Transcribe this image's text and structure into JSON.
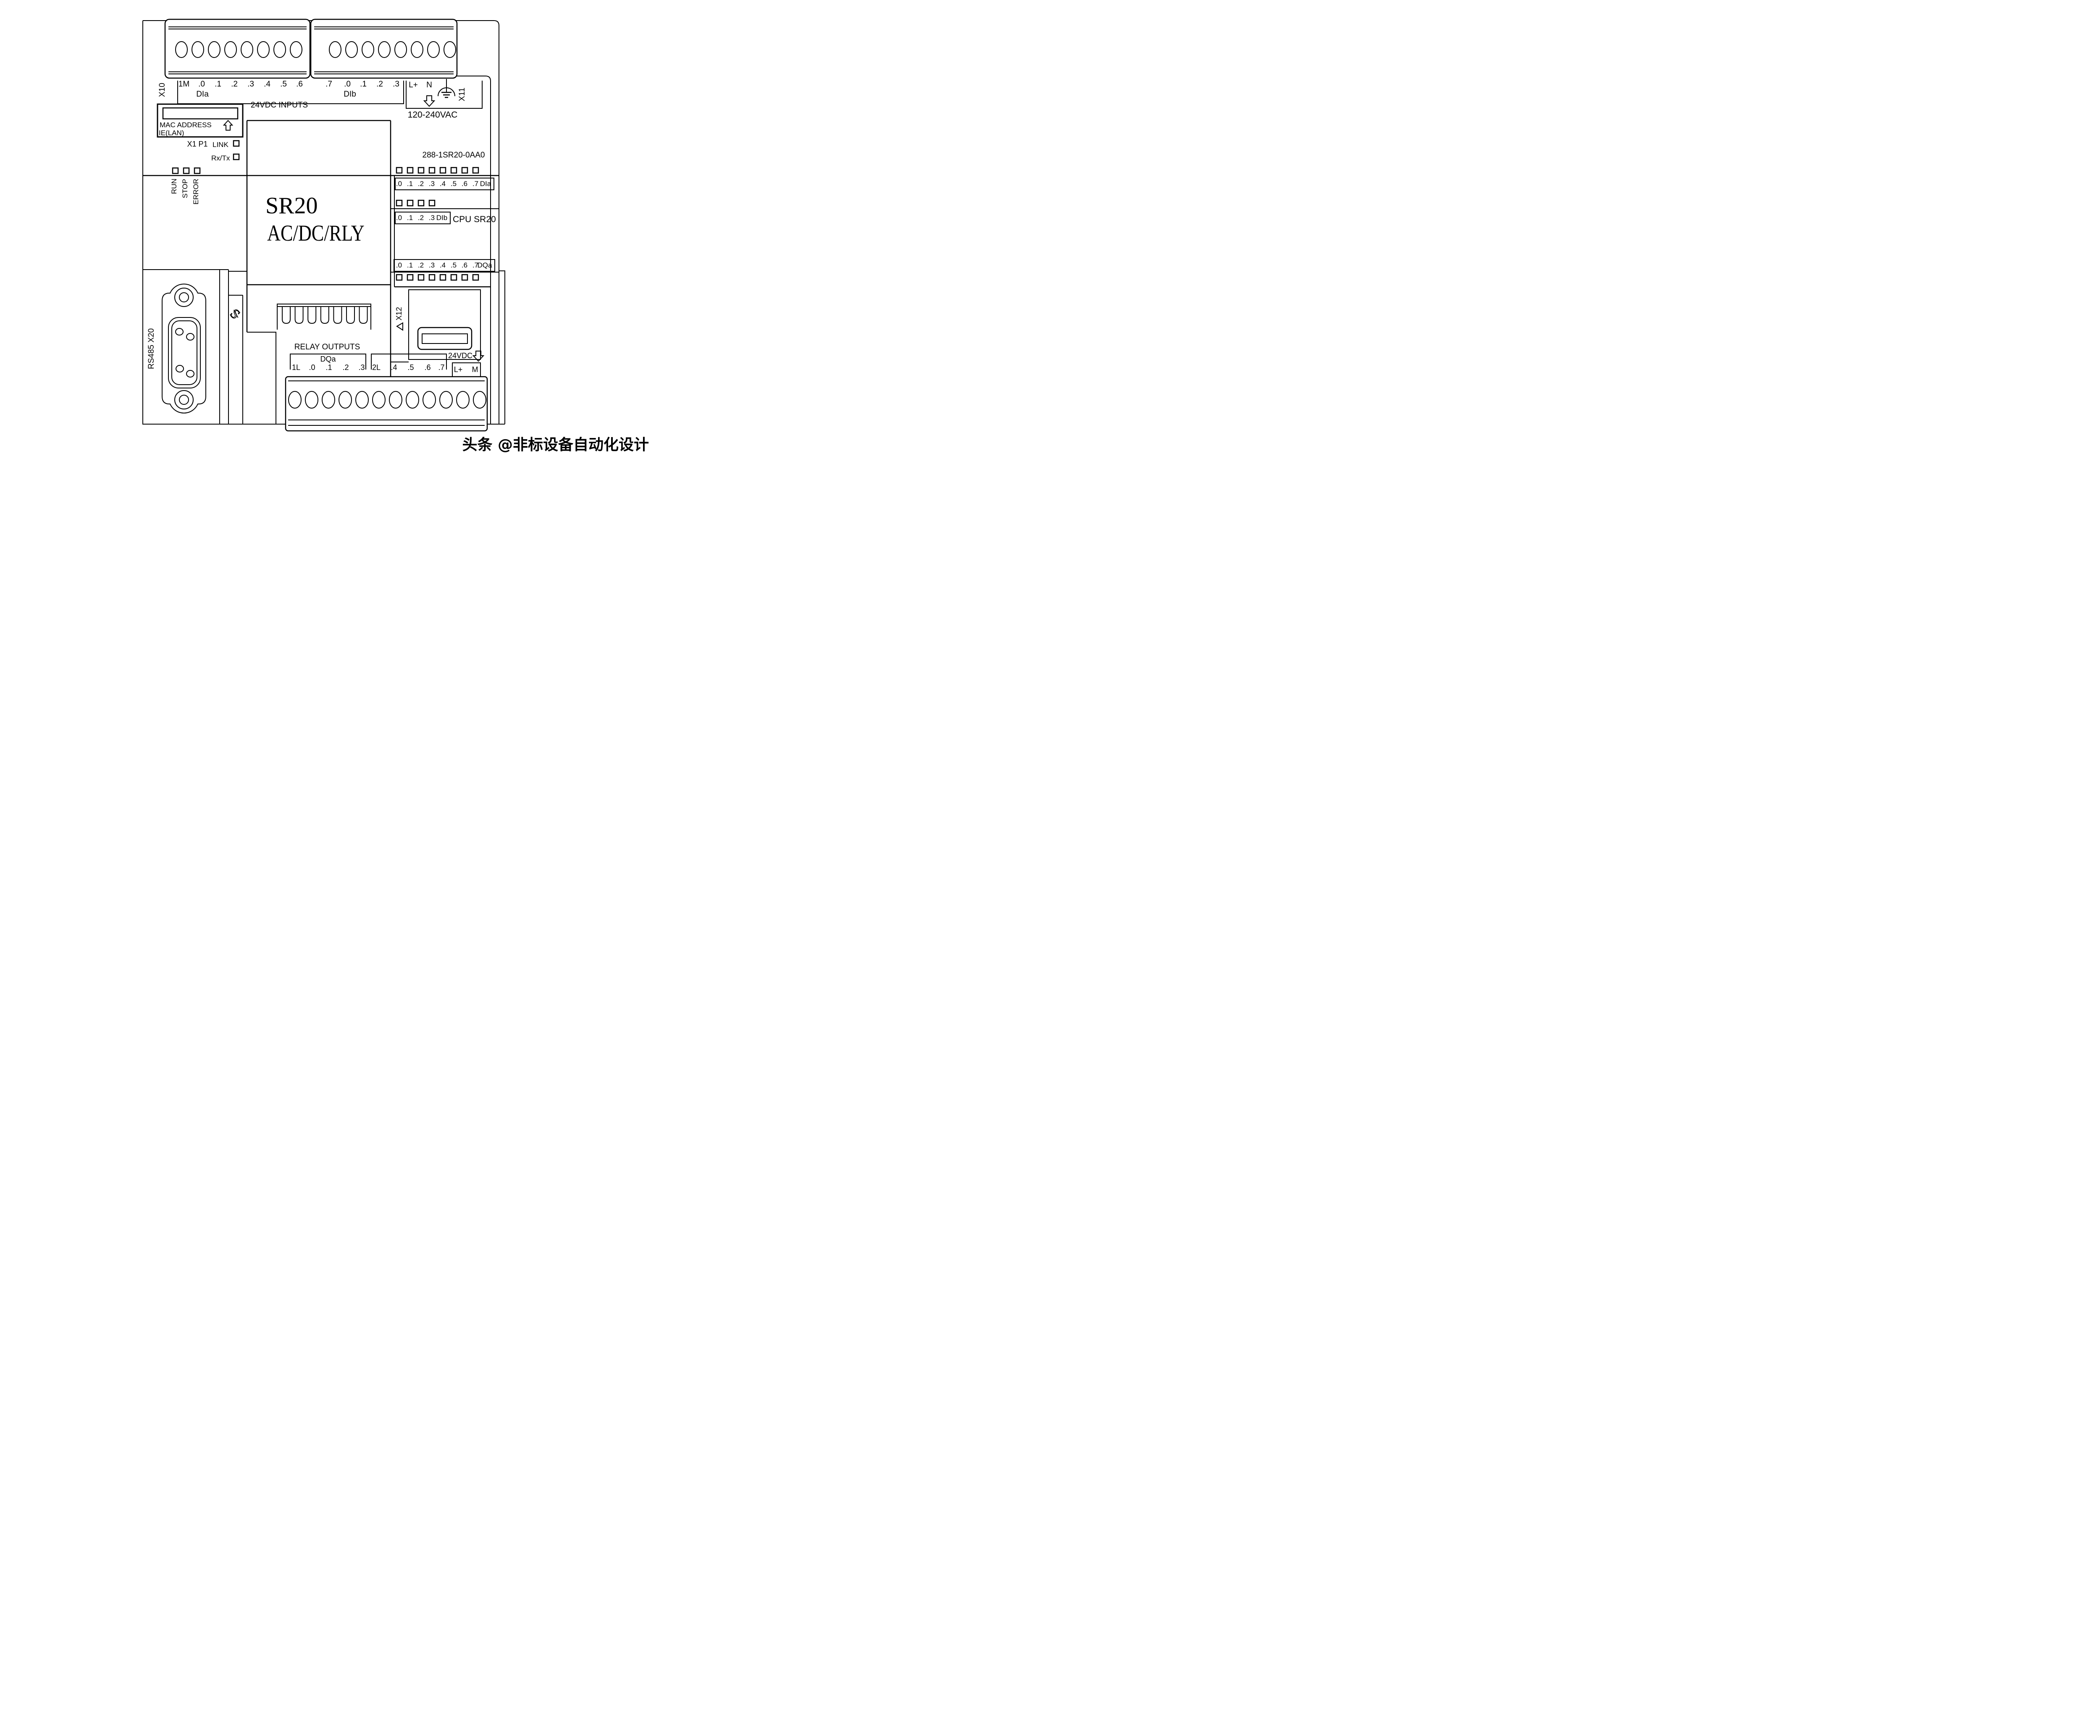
{
  "top": {
    "x10_label": "X10",
    "x11_label": "X11",
    "labels_left": [
      "1M",
      ".0",
      ".1",
      ".2",
      ".3",
      ".4",
      ".5",
      ".6"
    ],
    "labels_right": [
      ".7",
      ".0",
      ".1",
      ".2",
      ".3"
    ],
    "dia_group": "DIa",
    "dib_group": "DIb",
    "inputs_caption": "24VDC INPUTS",
    "power_lplus": "L+",
    "power_n": "N",
    "power_caption": "120-240VAC"
  },
  "ethernet": {
    "mac": "MAC ADDRESS",
    "ie": "IE(LAN)",
    "port": "X1 P1",
    "link": "LINK",
    "rxtx": "Rx/Tx"
  },
  "model": "288-1SR20-0AA0",
  "status": [
    "RUN",
    "STOP",
    "ERROR"
  ],
  "center": {
    "line1": "SR20",
    "line2": "AC/DC/RLY"
  },
  "cpu_label": "CPU SR20",
  "leds": {
    "dia": {
      "labels": [
        ".0",
        ".1",
        ".2",
        ".3",
        ".4",
        ".5",
        ".6",
        ".7"
      ],
      "name": "DIa"
    },
    "dib": {
      "labels": [
        ".0",
        ".1",
        ".2",
        ".3"
      ],
      "name": "DIb"
    },
    "dqa": {
      "labels": [
        ".0",
        ".1",
        ".2",
        ".3",
        ".4",
        ".5",
        ".6",
        ".7"
      ],
      "name": "DQa"
    }
  },
  "expansion": "X12",
  "serial": "RS485 X20",
  "outputs": {
    "caption": "RELAY OUTPUTS",
    "group": "DQa",
    "row1": [
      "1L",
      ".0",
      ".1",
      ".2",
      ".3"
    ],
    "row2": [
      "2L",
      ".4",
      ".5",
      ".6",
      ".7"
    ],
    "sensor": "24VDC",
    "sensor_terms": [
      "L+",
      "M"
    ]
  },
  "icons": {
    "ground": "protective-earth-icon",
    "arrow_down": "down-arrow-icon",
    "arrow_up": "up-arrow-icon",
    "expansion_triangle": "left-triangle-icon",
    "clip": "din-clip-icon"
  },
  "watermark": "头条 @非标设备自动化设计"
}
